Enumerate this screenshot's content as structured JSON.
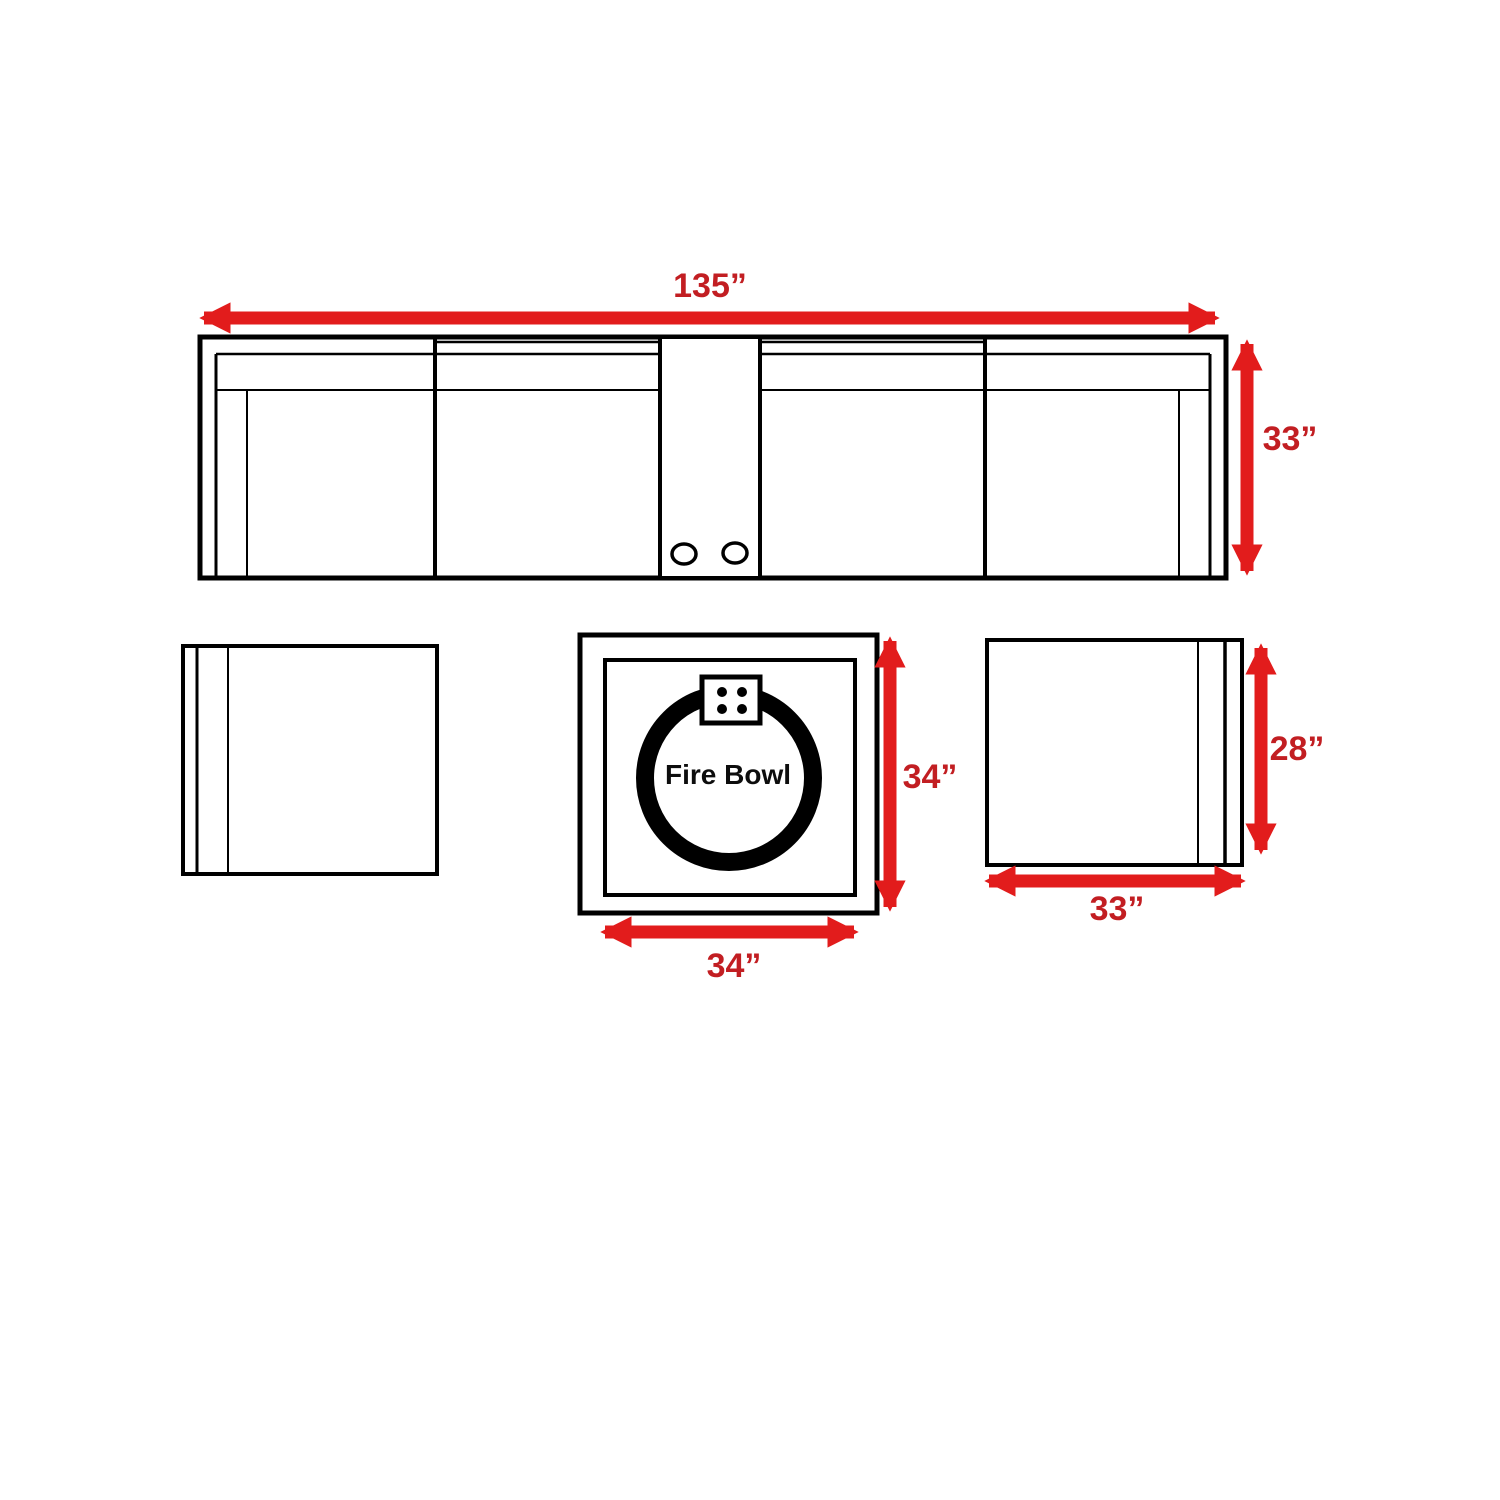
{
  "colors": {
    "arrow": "#e21c1c",
    "dimension_text": "#c21e22",
    "outline": "#000000",
    "background": "#ffffff"
  },
  "dimensions": {
    "sofa_width": "135”",
    "sofa_depth": "33”",
    "fire_table_depth": "34”",
    "fire_table_width": "34”",
    "end_table_depth": "28”",
    "end_table_width": "33”"
  },
  "fire_table": {
    "label": "Fire Bowl"
  }
}
